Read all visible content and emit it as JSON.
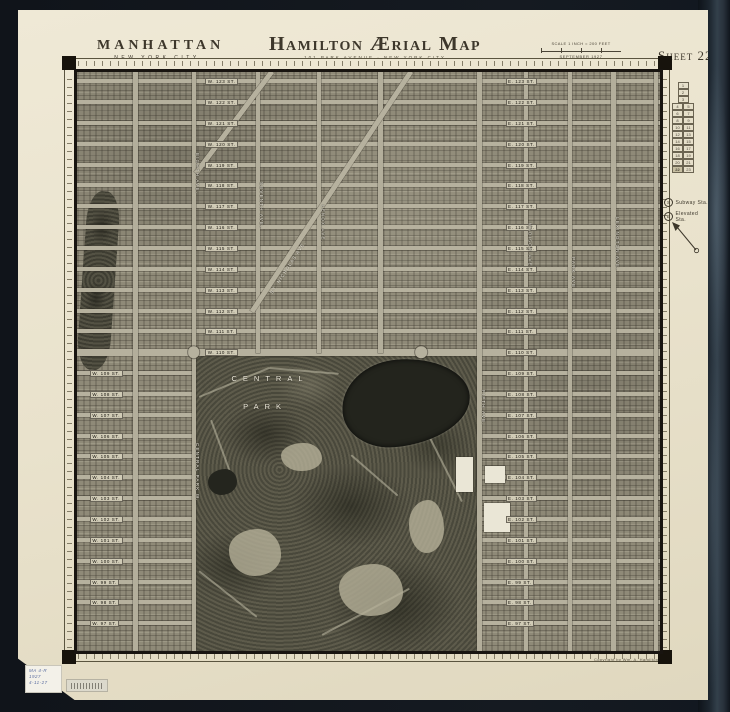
{
  "header": {
    "region_title": "MANHATTAN",
    "region_subtitle": "NEW YORK CITY",
    "title": "Hamilton Ærial Map",
    "subtitle": "101 PARK AVENUE · NEW YORK CITY",
    "scale_label": "SCALE 1 INCH = 200 FEET",
    "date_label": "SEPTEMBER 1927",
    "sheet_label": "Sheet 22"
  },
  "legend": {
    "subway_symbol": "S",
    "subway_label": "Subway Sta.",
    "elevated_symbol": "E",
    "elevated_label": "Elevated Sta.",
    "current_sheet": "22",
    "index_rows": [
      [
        "1"
      ],
      [
        "2"
      ],
      [
        "3"
      ],
      [
        "4",
        "5"
      ],
      [
        "6",
        "7"
      ],
      [
        "8",
        "9"
      ],
      [
        "10",
        "11"
      ],
      [
        "12",
        "13"
      ],
      [
        "14",
        "15"
      ],
      [
        "16",
        "17"
      ],
      [
        "18",
        "19"
      ],
      [
        "20",
        "21"
      ],
      [
        "22",
        "23"
      ]
    ]
  },
  "annotations": {
    "park_line1": "CENTRAL",
    "park_line2": "PARK",
    "copyright": "Copyright by Wm. A. Hamilton",
    "sticker": {
      "line1": "MA 4-R",
      "line2": "1927",
      "line3": "4-11-27"
    }
  },
  "map": {
    "streets": [
      {
        "y": 1.6,
        "wl": "W. 123 ST.",
        "el": "E. 123 ST.",
        "sp": "f"
      },
      {
        "y": 5.2,
        "wl": "W. 122 ST.",
        "el": "E. 122 ST.",
        "sp": "f"
      },
      {
        "y": 8.8,
        "wl": "W. 121 ST.",
        "el": "E. 121 ST.",
        "sp": "f"
      },
      {
        "y": 12.4,
        "wl": "W. 120 ST.",
        "el": "E. 120 ST.",
        "sp": "f"
      },
      {
        "y": 16.0,
        "wl": "W. 119 ST.",
        "el": "E. 119 ST.",
        "sp": "f"
      },
      {
        "y": 19.6,
        "wl": "W. 118 ST.",
        "el": "E. 118 ST.",
        "sp": "f"
      },
      {
        "y": 23.2,
        "wl": "W. 117 ST.",
        "el": "E. 117 ST.",
        "sp": "f"
      },
      {
        "y": 26.8,
        "wl": "W. 116 ST.",
        "el": "E. 116 ST.",
        "sp": "f"
      },
      {
        "y": 30.4,
        "wl": "W. 115 ST.",
        "el": "E. 115 ST.",
        "sp": "f"
      },
      {
        "y": 34.0,
        "wl": "W. 114 ST.",
        "el": "E. 114 ST.",
        "sp": "f"
      },
      {
        "y": 37.6,
        "wl": "W. 113 ST.",
        "el": "E. 113 ST.",
        "sp": "f"
      },
      {
        "y": 41.2,
        "wl": "W. 112 ST.",
        "el": "E. 112 ST.",
        "sp": "f"
      },
      {
        "y": 44.8,
        "wl": "W. 111 ST.",
        "el": "E. 111 ST.",
        "sp": "f"
      },
      {
        "y": 48.4,
        "wl": "W. 110 ST.",
        "el": "E. 110 ST.",
        "sp": "f",
        "wide": true
      },
      {
        "y": 52.0,
        "wl": "W. 109 ST.",
        "el": "E. 109 ST.",
        "sp": "s"
      },
      {
        "y": 55.6,
        "wl": "W. 108 ST.",
        "el": "E. 108 ST.",
        "sp": "s"
      },
      {
        "y": 59.2,
        "wl": "W. 107 ST.",
        "el": "E. 107 ST.",
        "sp": "s"
      },
      {
        "y": 62.8,
        "wl": "W. 106 ST.",
        "el": "E. 106 ST.",
        "sp": "s"
      },
      {
        "y": 66.4,
        "wl": "W. 105 ST.",
        "el": "E. 105 ST.",
        "sp": "s"
      },
      {
        "y": 70.0,
        "wl": "W. 104 ST.",
        "el": "E. 104 ST.",
        "sp": "s"
      },
      {
        "y": 73.6,
        "wl": "W. 103 ST.",
        "el": "E. 103 ST.",
        "sp": "s"
      },
      {
        "y": 77.2,
        "wl": "W. 102 ST.",
        "el": "E. 102 ST.",
        "sp": "s"
      },
      {
        "y": 80.8,
        "wl": "W. 101 ST.",
        "el": "E. 101 ST.",
        "sp": "s"
      },
      {
        "y": 84.4,
        "wl": "W. 100 ST.",
        "el": "E. 100 ST.",
        "sp": "s"
      },
      {
        "y": 88.0,
        "wl": "W. 99 ST.",
        "el": "E. 99 ST.",
        "sp": "s"
      },
      {
        "y": 91.6,
        "wl": "W. 98 ST.",
        "el": "E. 98 ST.",
        "sp": "s"
      },
      {
        "y": 95.2,
        "wl": "W. 97 ST.",
        "el": "E. 97 ST.",
        "sp": "s"
      }
    ],
    "avenues": [
      {
        "x": 10,
        "y1": 0,
        "y2": 100
      },
      {
        "x": 20,
        "y1": 0,
        "y2": 100
      },
      {
        "x": 31,
        "y1": 0,
        "y2": 48.6
      },
      {
        "x": 41.5,
        "y1": 0,
        "y2": 48.6
      },
      {
        "x": 52,
        "y1": 0,
        "y2": 48.6
      },
      {
        "x": 69,
        "y1": 0,
        "y2": 100
      },
      {
        "x": 77,
        "y1": 0,
        "y2": 100
      },
      {
        "x": 84.5,
        "y1": 0,
        "y2": 100
      },
      {
        "x": 92,
        "y1": 0,
        "y2": 100
      },
      {
        "x": 99.3,
        "y1": 0,
        "y2": 100
      }
    ],
    "av_labels": [
      {
        "x": 20.6,
        "y": 14,
        "t": "EIGHTH AVE."
      },
      {
        "x": 20.6,
        "y": 64,
        "t": "CENTRAL PARK W."
      },
      {
        "x": 31.6,
        "y": 19,
        "t": "SEVENTH AVE."
      },
      {
        "x": 42.1,
        "y": 23,
        "t": "LENOX AVE."
      },
      {
        "x": 69.6,
        "y": 55,
        "t": "FIFTH AVE."
      },
      {
        "x": 77.6,
        "y": 26,
        "t": "MADISON AVE."
      },
      {
        "x": 85.1,
        "y": 32,
        "t": "PARK AVE."
      },
      {
        "x": 92.6,
        "y": 25,
        "t": "LEXINGTON AVE."
      },
      {
        "x": 33,
        "y": 38,
        "t": "ST. NICHOLAS AVE.",
        "rot": -57
      }
    ],
    "diagonals": [
      {
        "x1": 57.3,
        "y1": -0.5,
        "x2": 30,
        "y2": 41
      },
      {
        "x1": 33.5,
        "y1": -0.5,
        "x2": 20.5,
        "y2": 17
      }
    ],
    "features": [
      {
        "type": "lake",
        "x": 45.5,
        "y": 49.5,
        "w": 22,
        "h": 15
      },
      {
        "type": "pond",
        "x": 22.5,
        "y": 68.5,
        "w": 5,
        "h": 4.5
      },
      {
        "type": "lawn",
        "x": 26,
        "y": 79,
        "w": 9,
        "h": 8
      },
      {
        "type": "lawn",
        "x": 45,
        "y": 85,
        "w": 11,
        "h": 9
      },
      {
        "type": "lawn",
        "x": 35,
        "y": 64,
        "w": 7,
        "h": 5
      },
      {
        "type": "lawn",
        "x": 57,
        "y": 74,
        "w": 6,
        "h": 9
      },
      {
        "type": "bldg",
        "x": 69.8,
        "y": 74.5,
        "w": 4.5,
        "h": 5
      },
      {
        "type": "bldg",
        "x": 65,
        "y": 66.5,
        "w": 3,
        "h": 6
      },
      {
        "type": "bldg",
        "x": 70,
        "y": 68,
        "w": 3.5,
        "h": 3
      },
      {
        "type": "circle",
        "x": 20,
        "y": 48.4,
        "w": 2,
        "h": 2
      },
      {
        "type": "circle",
        "x": 59,
        "y": 48.4,
        "w": 2,
        "h": 2
      }
    ],
    "paths": [
      {
        "x1": 21,
        "y1": 56,
        "x2": 33,
        "y2": 51
      },
      {
        "x1": 33,
        "y1": 51,
        "x2": 45,
        "y2": 52
      },
      {
        "x1": 21,
        "y1": 86,
        "x2": 31,
        "y2": 94
      },
      {
        "x1": 42,
        "y1": 97,
        "x2": 57,
        "y2": 89
      },
      {
        "x1": 60,
        "y1": 62,
        "x2": 66,
        "y2": 74
      },
      {
        "x1": 23,
        "y1": 60,
        "x2": 27,
        "y2": 71
      },
      {
        "x1": 47,
        "y1": 66,
        "x2": 55,
        "y2": 73
      }
    ]
  }
}
